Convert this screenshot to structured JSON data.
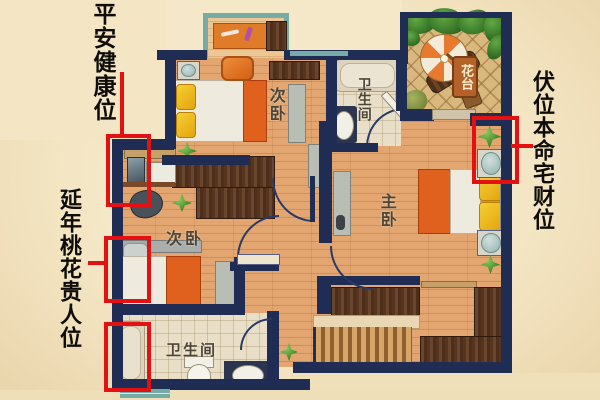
{
  "callouts": {
    "top_left": "平安健康位",
    "mid_left": "延年桃花贵人位",
    "right": "伏位本命宅财位"
  },
  "plan": {
    "bedroom_top_label": "次卧",
    "bedroom_left_label": "次卧",
    "master_label": "主卧",
    "bathroom_top_label": "卫生间",
    "bathroom_bottom_label": "卫生间",
    "terrace_label": "花台"
  },
  "colors": {
    "annotation_red": "#e31111",
    "wall_navy": "#1f2d55",
    "background_cream": "#f4e6c4",
    "wood_floor": "#e3a671"
  }
}
